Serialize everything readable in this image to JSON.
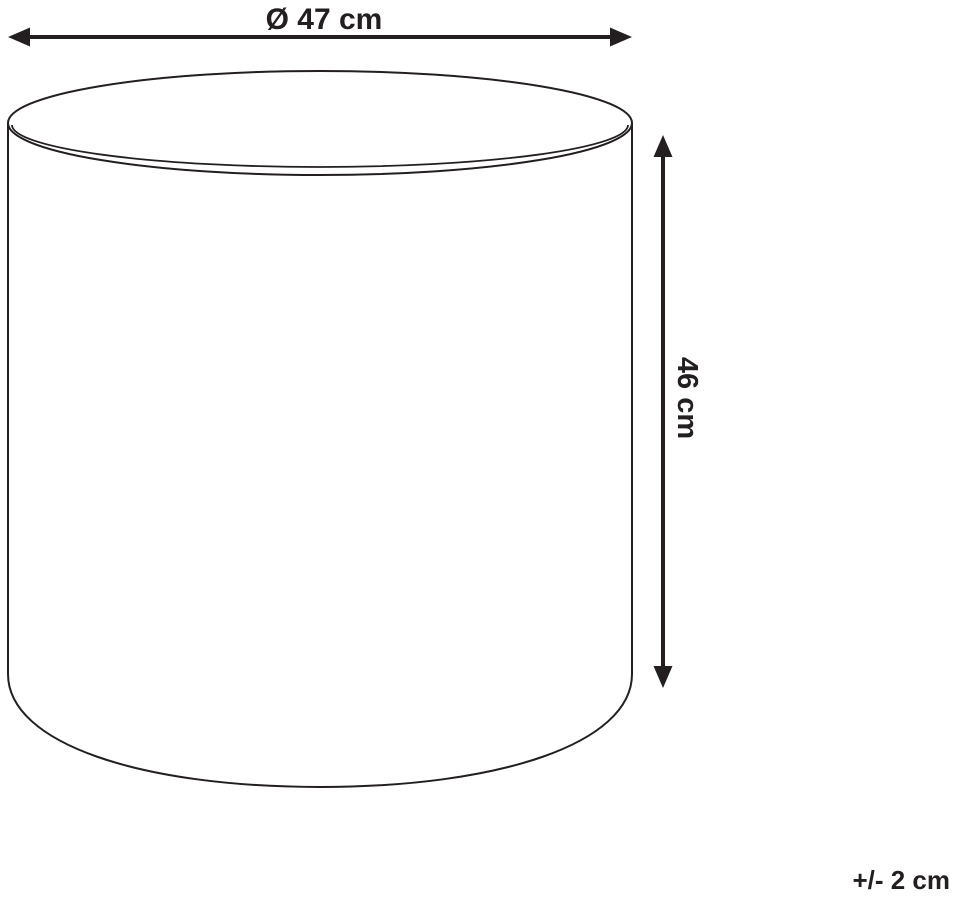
{
  "diagram": {
    "subject": "cylindrical-pouf",
    "width_label": "Ø 47 cm",
    "height_label": "46 cm",
    "tolerance_label": "+/- 2 cm",
    "line_color": "#231f20",
    "background_color": "#ffffff"
  }
}
